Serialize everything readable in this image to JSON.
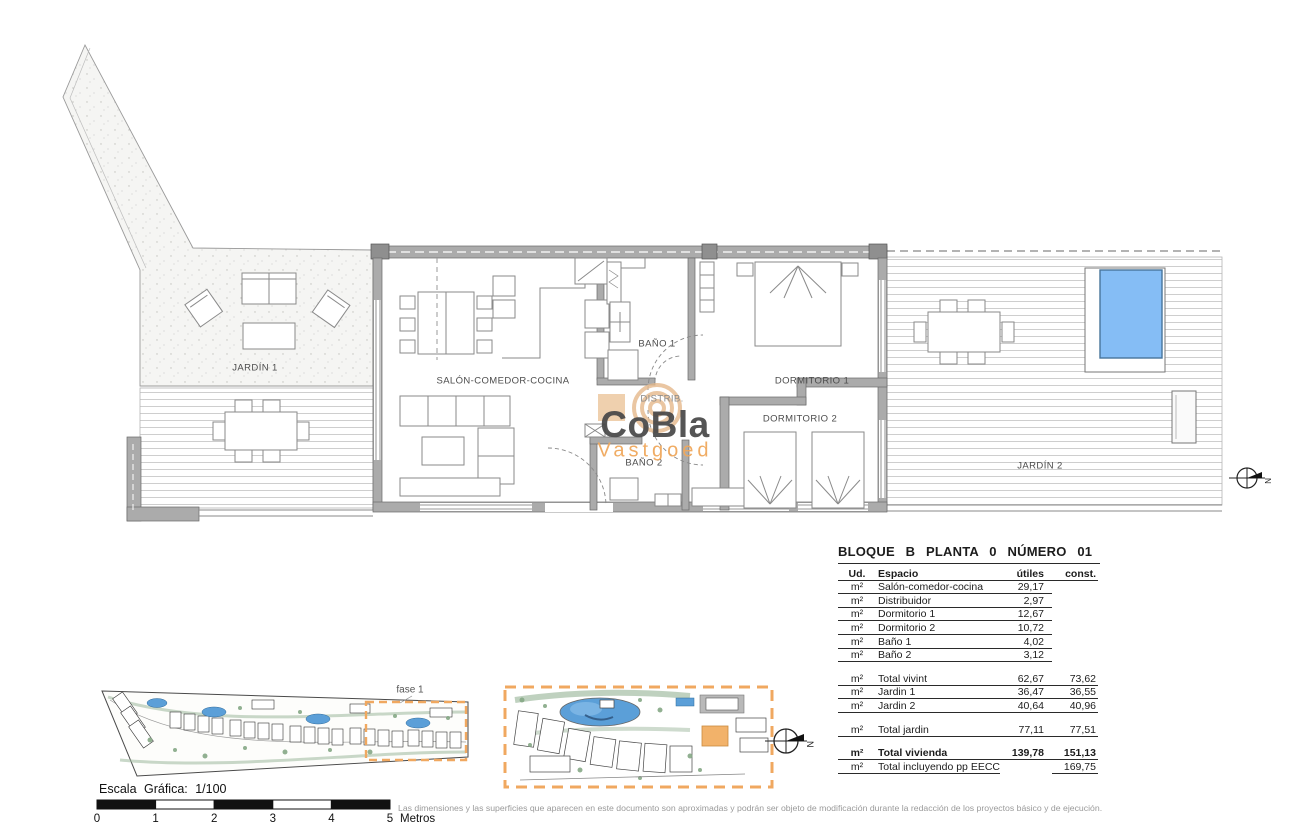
{
  "plan": {
    "rooms": {
      "jardin1": "JARDÍN 1",
      "salon": "SALÓN-COMEDOR-COCINA",
      "bano1": "BAÑO 1",
      "distrib": "DISTRIB.",
      "bano2": "BAÑO 2",
      "dorm1": "DORMITORIO 1",
      "dorm2": "DORMITORIO 2",
      "jardin2": "JARDÍN 2"
    },
    "compass_label": "N"
  },
  "logo": {
    "name": "CoBla",
    "sub": "Vastgoed"
  },
  "site": {
    "fase_label": "fase 1"
  },
  "table": {
    "title": "BLOQUE B PLANTA 0 NÚMERO 01",
    "headers": {
      "ud": "Ud.",
      "espacio": "Espacio",
      "utiles": "útiles",
      "const": "const."
    },
    "rows": [
      {
        "ud": "m²",
        "espacio": "Salón-comedor-cocina",
        "utiles": "29,17",
        "const": ""
      },
      {
        "ud": "m²",
        "espacio": "Distribuidor",
        "utiles": "2,97",
        "const": ""
      },
      {
        "ud": "m²",
        "espacio": "Dormitorio 1",
        "utiles": "12,67",
        "const": ""
      },
      {
        "ud": "m²",
        "espacio": "Dormitorio 2",
        "utiles": "10,72",
        "const": ""
      },
      {
        "ud": "m²",
        "espacio": "Baño 1",
        "utiles": "4,02",
        "const": ""
      },
      {
        "ud": "m²",
        "espacio": "Baño 2",
        "utiles": "3,12",
        "const": ""
      },
      {
        "ud": "m²",
        "espacio": "Total vivint",
        "utiles": "62,67",
        "const": "73,62"
      },
      {
        "ud": "m²",
        "espacio": "Jardin 1",
        "utiles": "36,47",
        "const": "36,55"
      },
      {
        "ud": "m²",
        "espacio": "Jardin 2",
        "utiles": "40,64",
        "const": "40,96"
      },
      {
        "ud": "m²",
        "espacio": "Total jardin",
        "utiles": "77,11",
        "const": "77,51"
      },
      {
        "ud": "m²",
        "espacio": "Total vivienda",
        "utiles": "139,78",
        "const": "151,13"
      },
      {
        "ud": "m²",
        "espacio": "Total incluyendo pp EECC",
        "utiles": "",
        "const": "169,75"
      }
    ]
  },
  "scale": {
    "label": "Escala Gráfica:  1/100",
    "ticks": [
      "0",
      "1",
      "2",
      "3",
      "4",
      "5"
    ],
    "unit": "Metros"
  },
  "disclaimer": "Las dimensiones y las superficies que aparecen en este documento son aproximadas y podrán ser objeto de modificación durante la redacción de los proyectos básico y de ejecución.",
  "colors": {
    "accent_orange": "#F0A860",
    "pool_blue": "#85BDF5",
    "wall_gray": "#ABABAB",
    "site_pool_blue": "#5B9FD8"
  }
}
